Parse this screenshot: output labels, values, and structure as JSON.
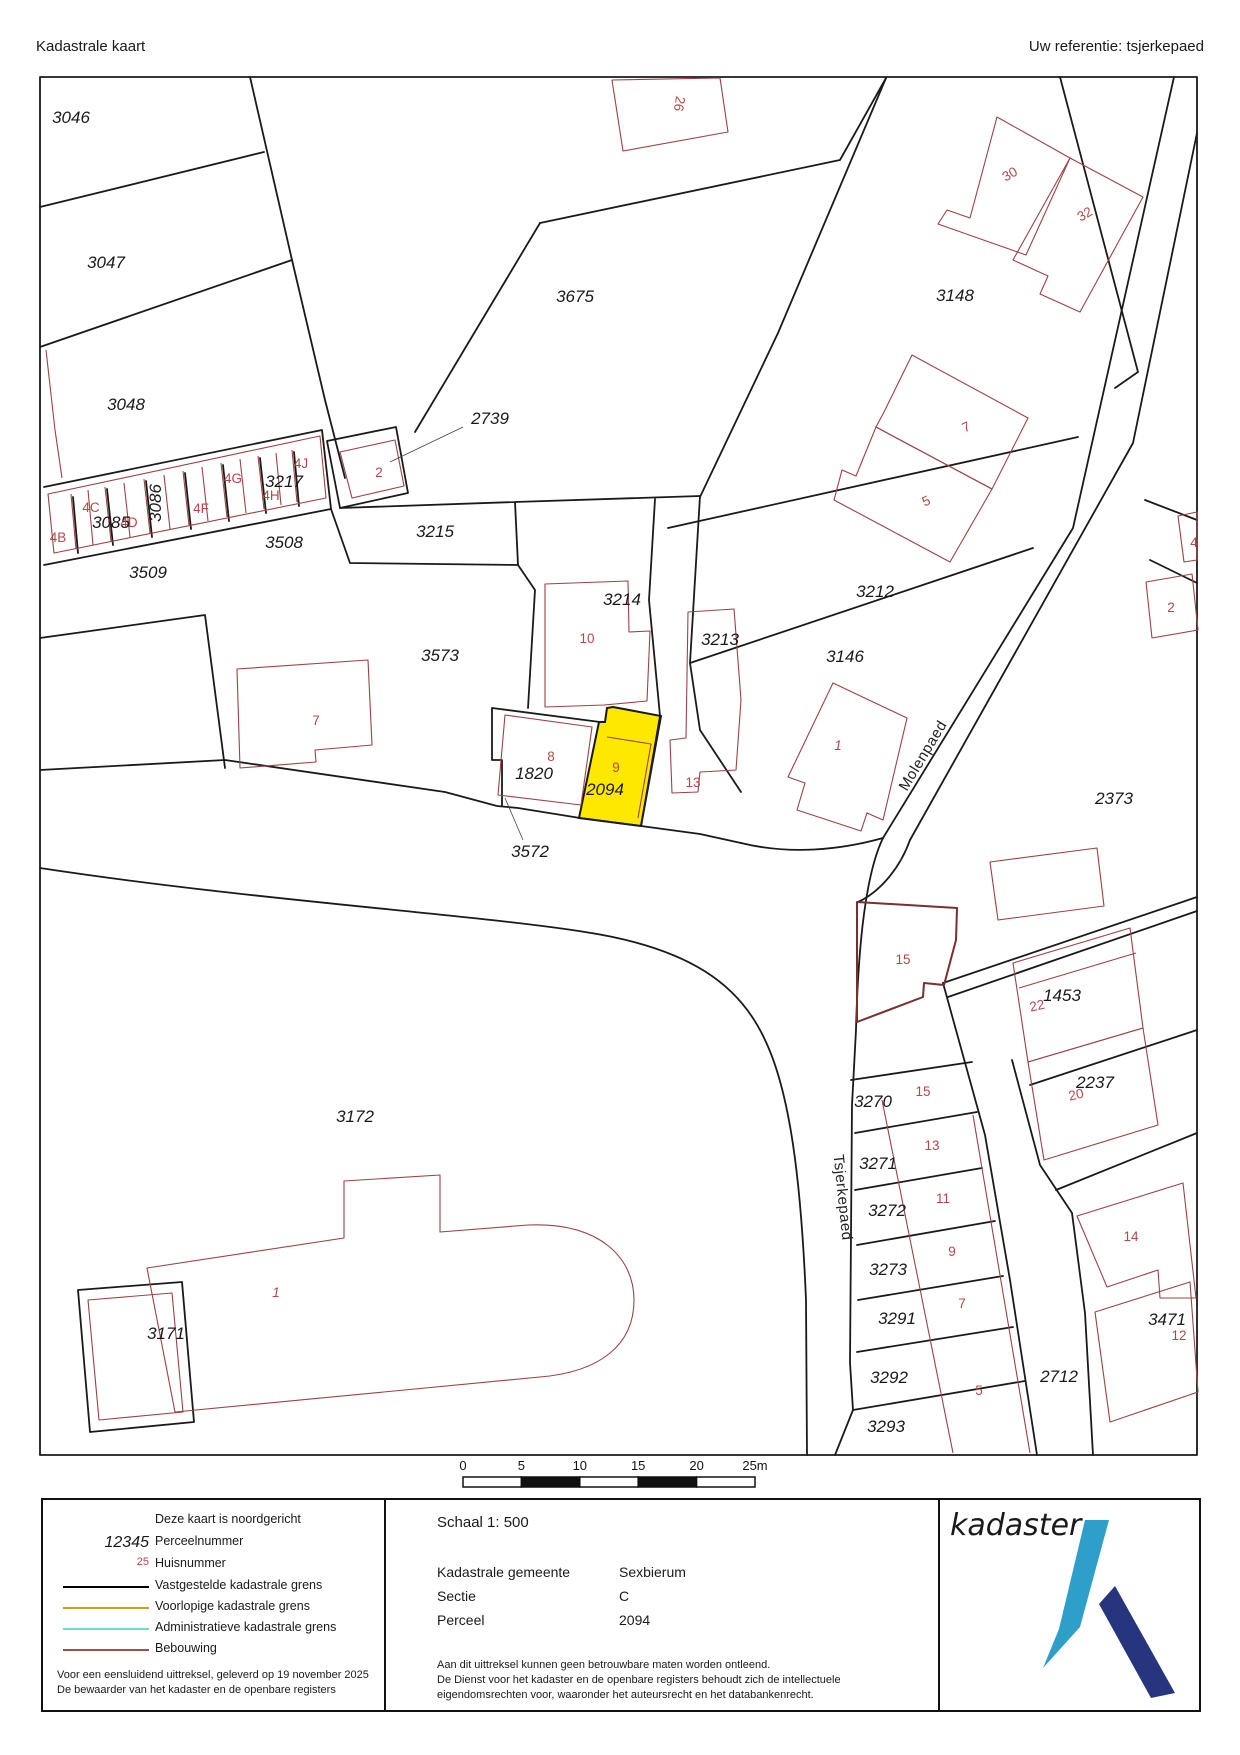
{
  "header": {
    "title": "Kadastrale kaart",
    "reference": "Uw referentie: tsjerkepaed"
  },
  "highlight": {
    "parcel": "2094",
    "color": "#ffe800"
  },
  "colors": {
    "boundary_fixed": "#000000",
    "boundary_provisional": "#bfa41e",
    "boundary_administrative": "#6fdccb",
    "building": "#a34b4b",
    "house_number": "#b34848",
    "logo_light": "#2e9fc9",
    "logo_dark": "#26357e"
  },
  "map": {
    "parcel_labels": [
      {
        "t": "3046",
        "x": 71,
        "y": 123
      },
      {
        "t": "3047",
        "x": 106,
        "y": 268
      },
      {
        "t": "3048",
        "x": 126,
        "y": 410
      },
      {
        "t": "3085",
        "x": 111,
        "y": 528
      },
      {
        "t": "3086",
        "x": 161,
        "y": 503,
        "r": -90
      },
      {
        "t": "3509",
        "x": 148,
        "y": 578
      },
      {
        "t": "3217",
        "x": 284,
        "y": 487
      },
      {
        "t": "3508",
        "x": 284,
        "y": 548
      },
      {
        "t": "2739",
        "x": 490,
        "y": 424
      },
      {
        "t": "3215",
        "x": 435,
        "y": 537
      },
      {
        "t": "3675",
        "x": 575,
        "y": 302
      },
      {
        "t": "3214",
        "x": 622,
        "y": 605
      },
      {
        "t": "3573",
        "x": 440,
        "y": 661
      },
      {
        "t": "3213",
        "x": 720,
        "y": 645
      },
      {
        "t": "3212",
        "x": 875,
        "y": 597
      },
      {
        "t": "3146",
        "x": 845,
        "y": 662
      },
      {
        "t": "3148",
        "x": 955,
        "y": 301
      },
      {
        "t": "1820",
        "x": 534,
        "y": 779
      },
      {
        "t": "2094",
        "x": 605,
        "y": 795
      },
      {
        "t": "3572",
        "x": 530,
        "y": 857
      },
      {
        "t": "2373",
        "x": 1114,
        "y": 804
      },
      {
        "t": "1453",
        "x": 1062,
        "y": 1001
      },
      {
        "t": "2237",
        "x": 1095,
        "y": 1088
      },
      {
        "t": "3172",
        "x": 355,
        "y": 1122
      },
      {
        "t": "3171",
        "x": 166,
        "y": 1339
      },
      {
        "t": "3270",
        "x": 873,
        "y": 1107
      },
      {
        "t": "3271",
        "x": 878,
        "y": 1169
      },
      {
        "t": "3272",
        "x": 887,
        "y": 1216
      },
      {
        "t": "3273",
        "x": 888,
        "y": 1275
      },
      {
        "t": "3291",
        "x": 897,
        "y": 1324
      },
      {
        "t": "3292",
        "x": 889,
        "y": 1383
      },
      {
        "t": "3293",
        "x": 886,
        "y": 1432
      },
      {
        "t": "2712",
        "x": 1059,
        "y": 1382
      },
      {
        "t": "3471",
        "x": 1167,
        "y": 1325
      }
    ],
    "house_numbers": [
      {
        "t": "4B",
        "x": 58,
        "y": 542
      },
      {
        "t": "4C",
        "x": 91,
        "y": 512
      },
      {
        "t": "4D",
        "x": 129,
        "y": 527
      },
      {
        "t": "4F",
        "x": 201,
        "y": 513
      },
      {
        "t": "4G",
        "x": 233,
        "y": 483
      },
      {
        "t": "4H",
        "x": 271,
        "y": 500
      },
      {
        "t": "4J",
        "x": 301,
        "y": 468
      },
      {
        "t": "2",
        "x": 379,
        "y": 477
      },
      {
        "t": "26",
        "x": 675,
        "y": 103,
        "r": 100
      },
      {
        "t": "30",
        "x": 1012,
        "y": 178,
        "r": -30
      },
      {
        "t": "32",
        "x": 1087,
        "y": 218,
        "r": -30
      },
      {
        "t": "7",
        "x": 968,
        "y": 431,
        "r": -25
      },
      {
        "t": "5",
        "x": 928,
        "y": 505,
        "r": -25
      },
      {
        "t": "4",
        "x": 1194,
        "y": 547
      },
      {
        "t": "2",
        "x": 1171,
        "y": 612
      },
      {
        "t": "10",
        "x": 587,
        "y": 643
      },
      {
        "t": "13",
        "x": 693,
        "y": 787
      },
      {
        "t": "8",
        "x": 551,
        "y": 761
      },
      {
        "t": "9",
        "x": 616,
        "y": 772
      },
      {
        "t": "1",
        "x": 838,
        "y": 750,
        "i": 1
      },
      {
        "t": "7",
        "x": 316,
        "y": 725
      },
      {
        "t": "1",
        "x": 276,
        "y": 1297,
        "i": 1
      },
      {
        "t": "15",
        "x": 903,
        "y": 964
      },
      {
        "t": "22",
        "x": 1038,
        "y": 1010,
        "r": -12
      },
      {
        "t": "20",
        "x": 1077,
        "y": 1099,
        "r": -12
      },
      {
        "t": "15",
        "x": 923,
        "y": 1096
      },
      {
        "t": "13",
        "x": 932,
        "y": 1150
      },
      {
        "t": "11",
        "x": 943,
        "y": 1203
      },
      {
        "t": "9",
        "x": 952,
        "y": 1256
      },
      {
        "t": "7",
        "x": 962,
        "y": 1308
      },
      {
        "t": "5",
        "x": 979,
        "y": 1395
      },
      {
        "t": "14",
        "x": 1131,
        "y": 1241
      },
      {
        "t": "12",
        "x": 1179,
        "y": 1340
      }
    ],
    "street_labels": [
      {
        "t": "Molenpaed",
        "x": 927,
        "y": 758,
        "r": -59
      },
      {
        "t": "Tsjerkepaed",
        "x": 838,
        "y": 1198,
        "r": 84
      }
    ],
    "scale_bar": {
      "ticks": [
        "0",
        "5",
        "10",
        "15",
        "20",
        "25m"
      ],
      "x0": 463,
      "dx": 58.4,
      "y_label": 1470,
      "bar_y": 1477,
      "bar_h": 10
    }
  },
  "legend": {
    "north_note": "Deze kaart is noordgericht",
    "items": [
      {
        "sample": "12345",
        "style": "parcel",
        "label": "Perceelnummer"
      },
      {
        "sample": "25",
        "style": "huis",
        "label": "Huisnummer"
      },
      {
        "line": "#000000",
        "label": "Vastgestelde kadastrale grens"
      },
      {
        "line": "#bfa41e",
        "label": "Voorlopige kadastrale grens"
      },
      {
        "line": "#6fdccb",
        "label": "Administratieve kadastrale grens"
      },
      {
        "line": "#a34b4b",
        "label": "Bebouwing"
      }
    ],
    "footer_line1": "Voor een eensluidend uittreksel, geleverd op 19 november 2025",
    "footer_line2": "De bewaarder van het kadaster en de openbare registers"
  },
  "info": {
    "schaal": "Schaal 1: 500",
    "rows": [
      {
        "label": "Kadastrale gemeente",
        "value": "Sexbierum"
      },
      {
        "label": "Sectie",
        "value": "C"
      },
      {
        "label": "Perceel",
        "value": "2094"
      }
    ],
    "disclaimer": [
      "Aan dit uittreksel kunnen geen betrouwbare maten worden ontleend.",
      "De Dienst voor het kadaster en de openbare registers behoudt zich de intellectuele",
      "eigendomsrechten voor, waaronder het auteursrecht en het databankenrecht."
    ]
  },
  "logo": {
    "text": "kadaster"
  }
}
